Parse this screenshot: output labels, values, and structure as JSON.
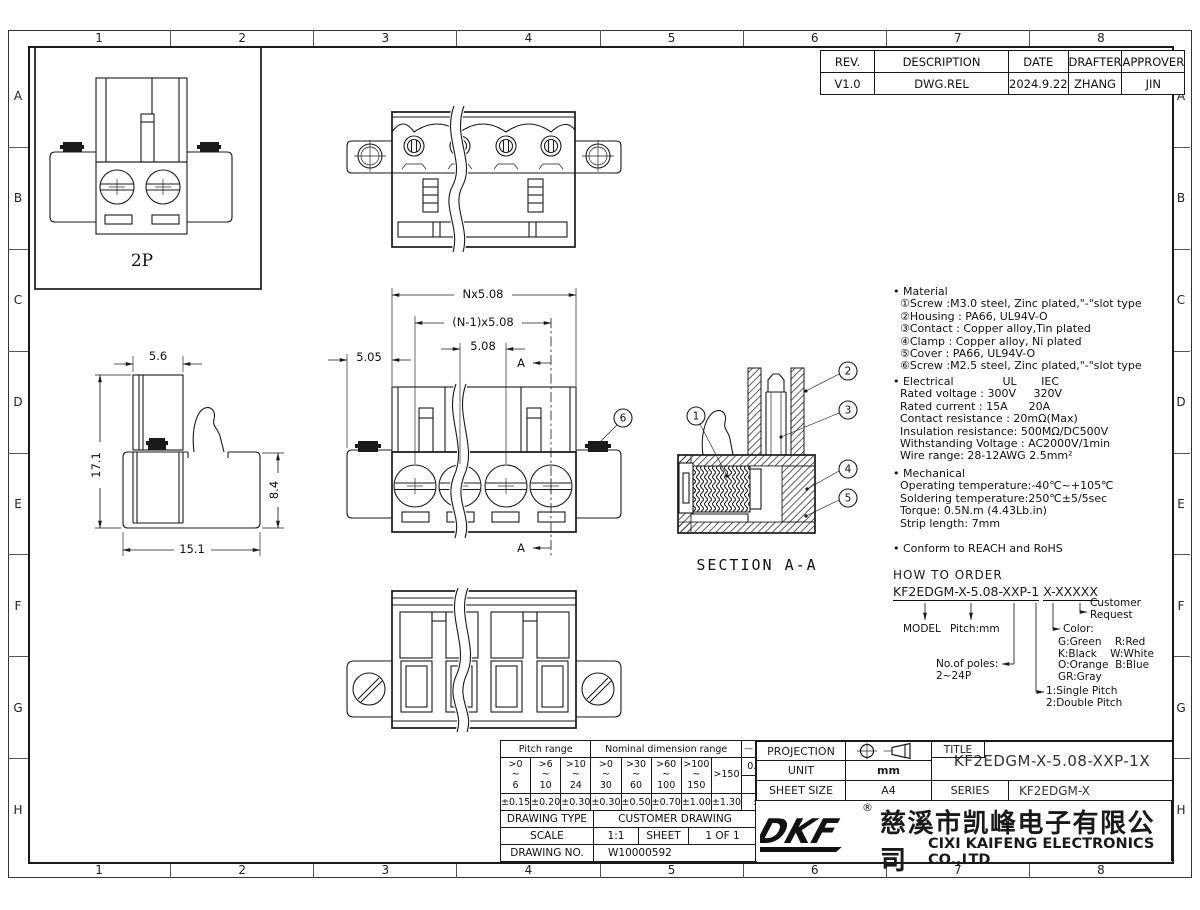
{
  "zones": {
    "cols": [
      "1",
      "2",
      "3",
      "4",
      "5",
      "6",
      "7",
      "8"
    ],
    "rows": [
      "A",
      "B",
      "C",
      "D",
      "E",
      "F",
      "G",
      "H"
    ]
  },
  "revision_table": {
    "headers": [
      "REV.",
      "DESCRIPTION",
      "DATE",
      "DRAFTER",
      "APPROVER"
    ],
    "row": [
      "V1.0",
      "DWG.REL",
      "2024.9.22",
      "ZHANG",
      "JIN"
    ]
  },
  "drawing": {
    "poles_label": "2P",
    "section_title": "SECTION A-A",
    "section_arrow": "A",
    "dims": {
      "pitch_overall": "Nx5.08",
      "pitch_n_minus_1": "(N-1)x5.08",
      "pitch": "5.08",
      "edge_offset": "5.05",
      "top_width": "5.6",
      "total_height": "17.1",
      "body_height": "8.4",
      "body_depth": "15.1"
    },
    "balloons": {
      "b1": "1",
      "b2": "2",
      "b3": "3",
      "b4": "4",
      "b5": "5",
      "b6": "6"
    }
  },
  "notes": {
    "material": {
      "lines": [
        "• Material",
        "  ①Screw :M3.0 steel, Zinc plated,\"-\"slot type",
        "  ②Housing : PA66, UL94V-O",
        "  ③Contact : Copper alloy,Tin plated",
        "  ④Clamp : Copper alloy, Ni plated",
        "  ⑤Cover : PA66, UL94V-O",
        "  ⑥Screw :M2.5 steel, Zinc plated,\"-\"slot type"
      ]
    },
    "electrical": {
      "lines": [
        "• Electrical              UL       IEC",
        "  Rated voltage : 300V     320V",
        "  Rated current : 15A      20A",
        "  Contact resistance : 20mΩ(Max)",
        "  Insulation resistance: 500MΩ/DC500V",
        "  Withstanding Voltage : AC2000V/1min",
        "  Wire range: 28-12AWG 2.5mm²"
      ]
    },
    "mechanical": {
      "lines": [
        "• Mechanical",
        "  Operating temperature:-40℃~+105℃",
        "  Soldering temperature:250℃±5/5sec",
        "  Torque: 0.5N.m (4.43Lb.in)",
        "  Strip length: 7mm"
      ]
    },
    "compliance": "• Conform to REACH and RoHS"
  },
  "ordering": {
    "title": "HOW TO ORDER",
    "code_model": "KF2EDGM-X-5.08-XXP-1",
    "code_suffix": "X-XXXXX",
    "model_label": "MODEL",
    "pitch_label": "Pitch:mm",
    "poles_label": "No.of poles:\n2~24P",
    "pitch_type": "1:Single Pitch\n2:Double Pitch",
    "color_label": "Color:",
    "colors": "G:Green    R:Red\nK:Black    W:White\nO:Orange  B:Blue\nGR:Gray",
    "customer": "Customer\nRequest"
  },
  "tolerance_table": {
    "pitch_header": "Pitch range",
    "nominal_header": "Nominal dimension range",
    "symbols": [
      "—",
      "⌒",
      "▱"
    ],
    "pitch_ranges": [
      ">0\n~\n6",
      ">6\n~\n10",
      ">10\n~\n24"
    ],
    "nominal_ranges": [
      ">0\n~\n30",
      ">30\n~\n60",
      ">60\n~\n100",
      ">100\n~\n150"
    ],
    "over_range": ">150",
    "straightness": "0.1/10",
    "angle_symbol": "∠",
    "pitch_tols": [
      "±0.15",
      "±0.20",
      "±0.30"
    ],
    "nominal_tols": [
      "±0.30",
      "±0.50",
      "±0.70",
      "±1.00",
      "±1.30"
    ],
    "angle_tol": "±2°"
  },
  "title_block": {
    "drawing_type_label": "DRAWING TYPE",
    "drawing_type": "CUSTOMER DRAWING",
    "scale_label": "SCALE",
    "scale": "1:1",
    "sheet_label": "SHEET",
    "sheet": "1 OF 1",
    "drawing_no_label": "DRAWING NO.",
    "drawing_no": "W10000592",
    "projection_label": "PROJECTION",
    "unit_label": "UNIT",
    "unit": "mm",
    "sheet_size_label": "SHEET SIZE",
    "sheet_size": "A4",
    "title_label": "TITLE",
    "title": "KF2EDGM-X-5.08-XXP-1X",
    "series_label": "SERIES",
    "series": "KF2EDGM-X",
    "company_cn": "慈溪市凯峰电子有限公司",
    "company_en": "CIXI KAIFENG ELECTRONICS CO.,LTD",
    "logo_text": "DKF",
    "registered": "®"
  }
}
